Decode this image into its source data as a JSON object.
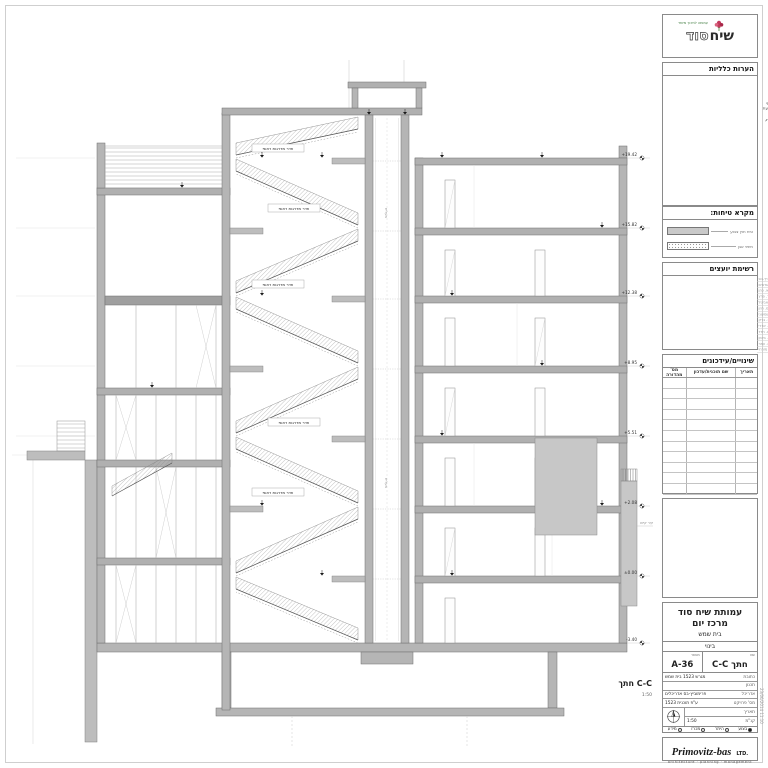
{
  "sheet": {
    "section_label": "חתך C-C",
    "section_scale": "1:50",
    "plot_stamp": "23/06/2014 11:10"
  },
  "drawing": {
    "stair_label": "חדר מדרגות ראשי",
    "elevator_label": "מעלית",
    "side_note": "קיר קיים",
    "levels": [
      "+19.42",
      "+15.82",
      "+12.38",
      "+8.95",
      "+5.51",
      "+2.08",
      "±0.00",
      "-3.40"
    ]
  },
  "sidebar": {
    "logo": {
      "brand_a": "שיח",
      "brand_b": "סוד",
      "tagline": "עמותה לחינוך מיוחד"
    },
    "notes": {
      "title": "הערות כלליות",
      "items": [
        "יש לקרוא תוכנית זו ביחד עם כל תוכניות האדריכלות, הקונסטרוקציה והיועצים.",
        "אין למדוד מתוכנית זו, המידות הקובעות הן המידות הרשומות בלבד.",
        "על הקבלן לבדוק את כל המידות באתר לפני תחילת הביצוע, כל סתירה תובא מיידית לידיעת האדריכל.",
        "כל המידות נתונות בס\"מ אלא אם צוין אחרת, מפלסים במטרים.",
        "פרטי מעקות ומסעדים ראה גיליון פרטים.",
        "גמר קירות חוץ ע\"פ מקרא טיחות וחזיתות.",
        "יש לבצע איטום ע\"פ מפרט יועץ האיטום."
      ],
      "footer": "תוכנית זו הינה רכוש המשרד. אין להעתיק, לצלם או להשתמש בה ללא אישור בכתב מהאדריכל."
    },
    "legend": {
      "title": "מקרא טיחות:",
      "item1": "טיח חוץ צבוע",
      "item2": "חיפוי אבן"
    },
    "consultants": {
      "title": "רשימת יועצים",
      "rows": [
        {
          "role": "אדריכלות",
          "name": "פרימוביץ-בס"
        },
        {
          "role": "קונסטרוקציה",
          "name": "י. לוי מהנדסים"
        },
        {
          "role": "אינסטלציה",
          "name": "א. כהן"
        },
        {
          "role": "חשמל",
          "name": "ד. פרץ"
        },
        {
          "role": "מיזוג אוויר",
          "name": "ש. אביטל"
        },
        {
          "role": "בטיחות",
          "name": "מ. רוזן"
        },
        {
          "role": "נגישות",
          "name": "ח. שמעוני"
        },
        {
          "role": "יועץ קרקע",
          "name": "ג. ברק"
        },
        {
          "role": "מעליות",
          "name": "ל. אדרי"
        },
        {
          "role": "איטום",
          "name": "נ. חדד"
        },
        {
          "role": "תנועה",
          "name": "ר. ביטון"
        },
        {
          "role": "מטבחים",
          "name": "ת. עמר"
        },
        {
          "role": "פיתוח",
          "name": "ב. מזרחי"
        }
      ]
    },
    "revisions": {
      "title": "שינויים/עידכונים",
      "col_date": "תאריך",
      "col_desc": "שם תוכנית/עדכון",
      "col_num": "מס' מהדורה"
    },
    "titleblock": {
      "client": "עמותת שיח סוד",
      "project": "מרכז יום",
      "city": "בית שמש",
      "stage": "בינוי",
      "name_label": "שם",
      "name": "חתך C-C",
      "number_label": "מספר",
      "number": "A-36",
      "address_label": "כתובת",
      "address": "מגרש 1523 בית שמש",
      "row1_label": "תכנון",
      "row1_value": "",
      "row2_label": "אדריכל",
      "row2_value": "פרימוביץ-בס אדריכלים",
      "row3_label": "מס' פרויקט",
      "row3_value": "ע\"פ תוכנית 1523",
      "date_label": "תאריך",
      "date_value": "",
      "scale_label": "קנ\"מ",
      "scale_value": "1:50",
      "status": [
        {
          "label": "בצוע",
          "selected": true
        },
        {
          "label": "היתר",
          "selected": false
        },
        {
          "label": "מכרז",
          "selected": false
        },
        {
          "label": "מידע",
          "selected": false
        }
      ]
    },
    "firm": {
      "name": "Primovitz-bas",
      "suffix": "LTD.",
      "tagline": "architecture · planning · management"
    }
  }
}
